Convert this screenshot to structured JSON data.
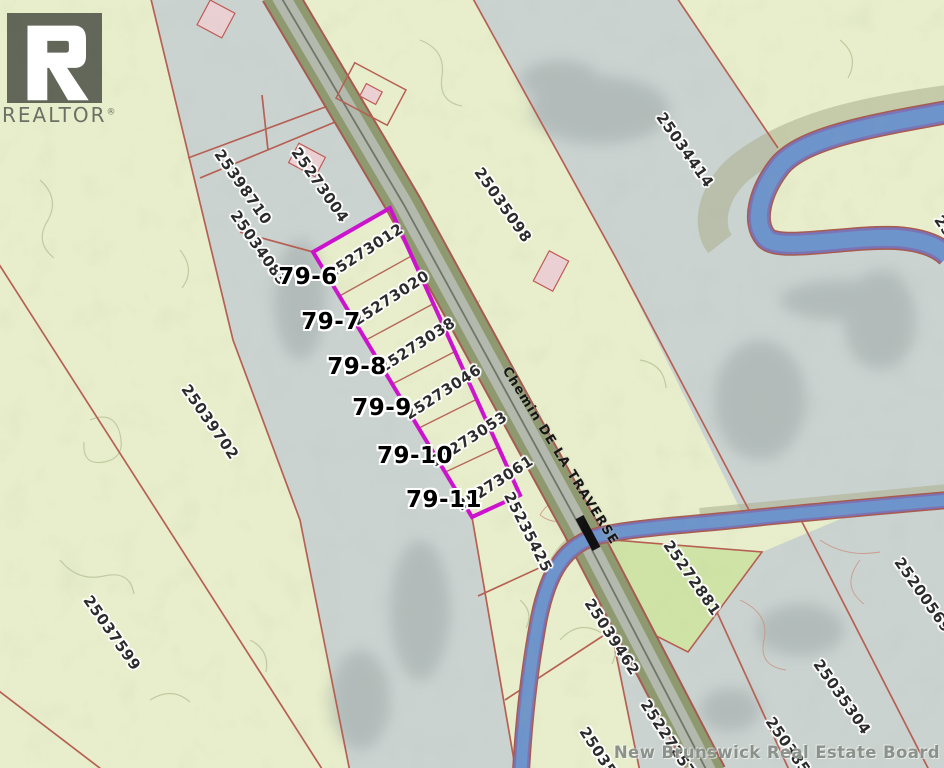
{
  "map": {
    "branding": {
      "logo_text": "REALTOR",
      "logo_registered": "®",
      "watermark": "New Brunswick Real Estate Board"
    },
    "road_label": "Chemin DE LA TRAVERSE",
    "highlighted_lots": {
      "outline_color": "#cc12cd",
      "lots": [
        {
          "lot_number": "79-6",
          "parcel_id": "25273012"
        },
        {
          "lot_number": "79-7",
          "parcel_id": "25273020"
        },
        {
          "lot_number": "79-8",
          "parcel_id": "25273038"
        },
        {
          "lot_number": "79-9",
          "parcel_id": "25273046"
        },
        {
          "lot_number": "79-10",
          "parcel_id": "25273053"
        },
        {
          "lot_number": "79-11",
          "parcel_id": "25273061"
        }
      ]
    },
    "parcel_ids": [
      "25398710",
      "25273004",
      "25034083",
      "25035098",
      "25034414",
      "25039702",
      "25037599",
      "25235425",
      "25039462",
      "25272881",
      "25200569",
      "25035304",
      "2503852",
      "25227257",
      "250352",
      "25"
    ],
    "colors": {
      "terrain_green": "#e8eecb",
      "terrain_gray": "#cbd3d1",
      "featured_parcel_green": "#cfe3a6",
      "parcel_line_red": "#b65f52",
      "water_blue": "#6d94cb",
      "water_casing_purple": "#7c73b5",
      "road_pavement": "#b4b9ae",
      "road_shoulder": "#8e996f",
      "highlight_magenta": "#cc12cd"
    }
  }
}
